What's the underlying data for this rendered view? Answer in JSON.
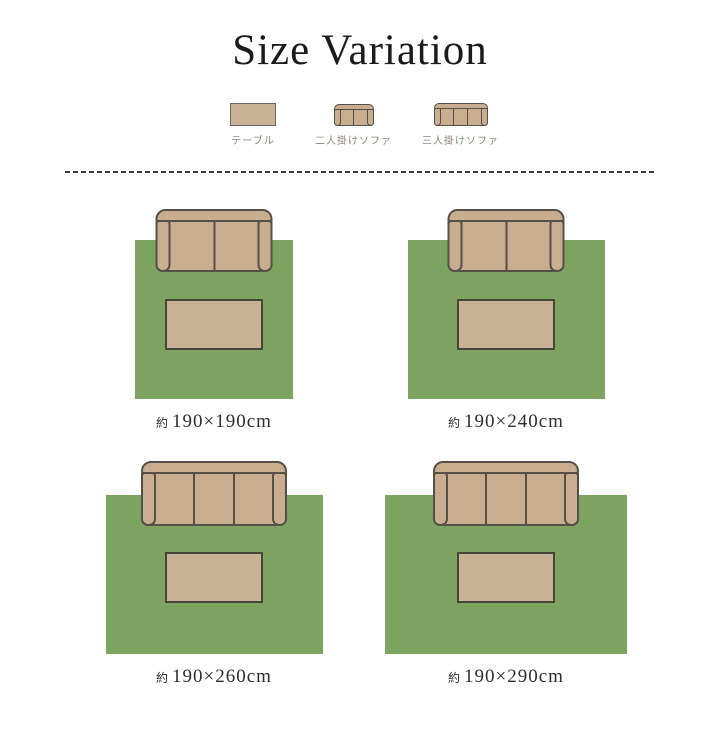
{
  "title": "Size Variation",
  "colors": {
    "rug_green": "#7ca460",
    "sofa_tan": "#c9ad8f",
    "table_tan": "#c9b195",
    "outline": "#55514a",
    "legend_text": "#8d8577",
    "title_text": "#1b1b1b",
    "size_label_text": "#2d2d2d"
  },
  "legend": {
    "items": [
      {
        "icon": "table-icon",
        "label": "テーブル"
      },
      {
        "icon": "two-seat-sofa-icon",
        "label": "二人掛けソファ"
      },
      {
        "icon": "three-seat-sofa-icon",
        "label": "三人掛けソファ"
      }
    ]
  },
  "diagrams": [
    {
      "size_prefix": "約",
      "size_label": "190×190cm",
      "sofa": "two-seater",
      "rug_px_width": 158
    },
    {
      "size_prefix": "約",
      "size_label": "190×240cm",
      "sofa": "two-seater",
      "rug_px_width": 197
    },
    {
      "size_prefix": "約",
      "size_label": "190×260cm",
      "sofa": "three-seater",
      "rug_px_width": 217
    },
    {
      "size_prefix": "約",
      "size_label": "190×290cm",
      "sofa": "three-seater",
      "rug_px_width": 242
    }
  ]
}
